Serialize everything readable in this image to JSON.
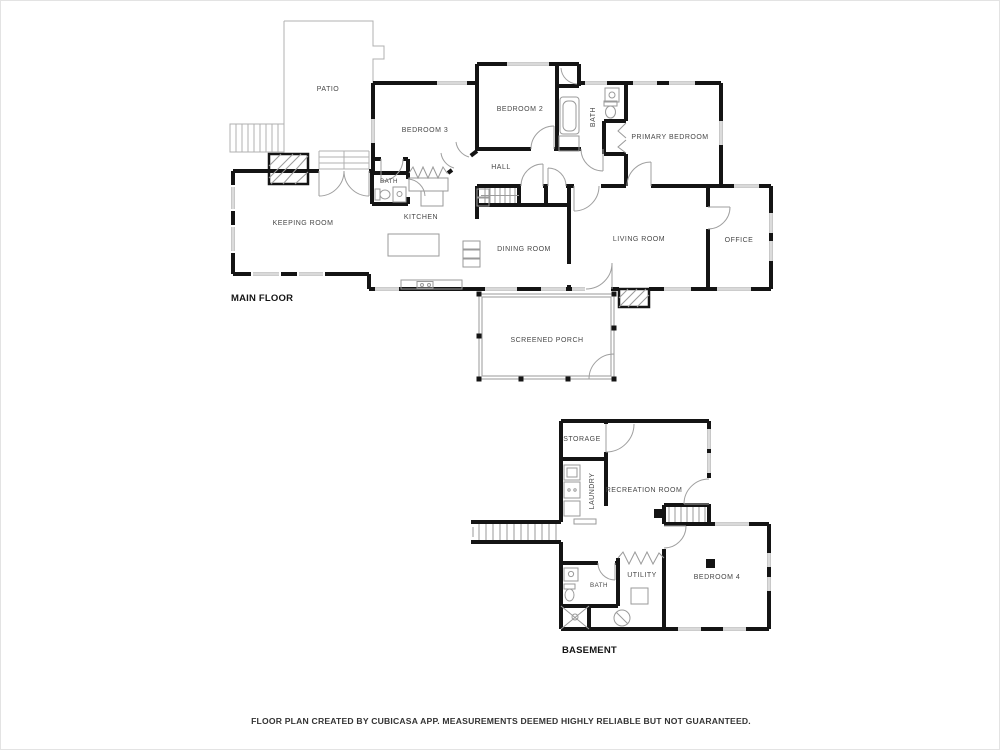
{
  "caption": "FLOOR PLAN CREATED BY CUBICASA APP. MEASUREMENTS DEEMED HIGHLY RELIABLE BUT NOT GUARANTEED.",
  "floors": {
    "main": {
      "label": "MAIN FLOOR",
      "rooms": {
        "patio": "PATIO",
        "bedroom3": "BEDROOM 3",
        "bedroom2": "BEDROOM 2",
        "bath_hall": "BATH",
        "primary_bedroom": "PRIMARY BEDROOM",
        "hall": "HALL",
        "keeping_room": "KEEPING ROOM",
        "bath": "BATH",
        "kitchen": "KITCHEN",
        "dining_room": "DINING ROOM",
        "living_room": "LIVING ROOM",
        "office": "OFFICE",
        "screened_porch": "SCREENED PORCH"
      }
    },
    "basement": {
      "label": "BASEMENT",
      "rooms": {
        "storage": "STORAGE",
        "laundry": "LAUNDRY",
        "recreation_room": "RECREATION ROOM",
        "bath": "BATH",
        "utility": "UTILITY",
        "bedroom4": "BEDROOM 4"
      }
    }
  },
  "colors": {
    "wall": "#141414",
    "thin_line": "#9a9a9a",
    "room_label": "#474747",
    "floor_label": "#151515"
  }
}
